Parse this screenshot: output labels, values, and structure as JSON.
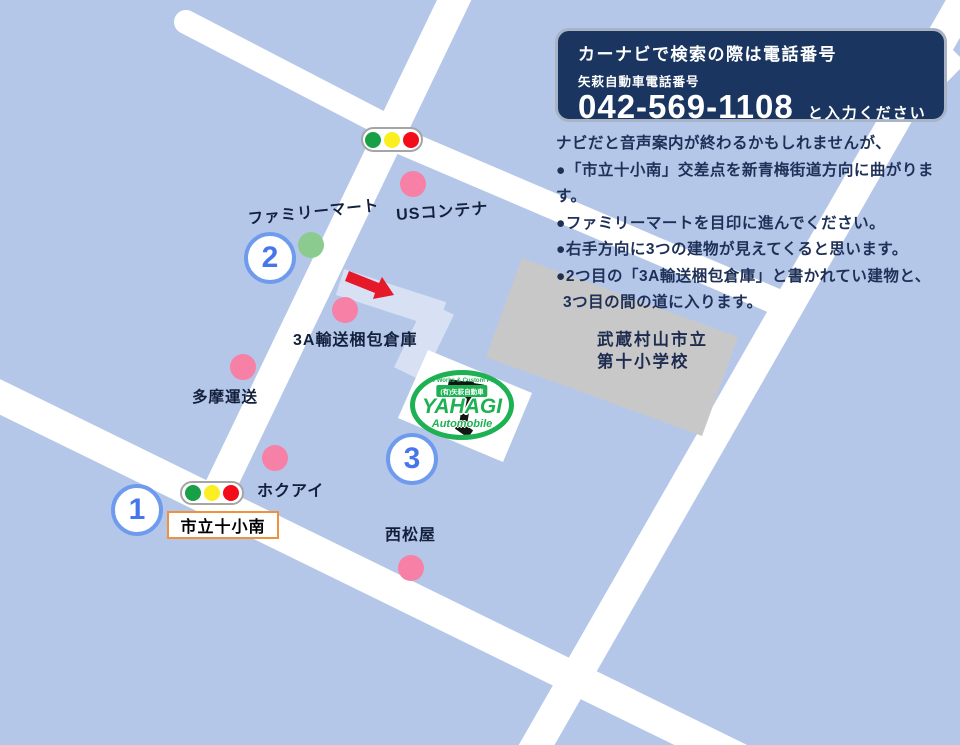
{
  "info_box": {
    "title": "カーナビで検索の際は電話番号",
    "subtitle": "矢萩自動車電話番号",
    "phone": "042-569-1108",
    "phone_suffix": "と入力ください"
  },
  "directions": {
    "intro": "ナビだと音声案内が終わるかもしれませんが、",
    "steps": [
      "●「市立十小南」交差点を新青梅街道方向に曲がります。",
      "●ファミリーマートを目印に進んでください。",
      "●右手方向に3つの建物が見えてくると思います。",
      "●2つ目の「3A輸送梱包倉庫」と書かれてい建物と、",
      "3つ目の間の道に入ります。"
    ]
  },
  "landmarks": {
    "family_mart": "ファミリーマート",
    "us_container": "USコンテナ",
    "warehouse_3a": "3A輸送梱包倉庫",
    "tama_unsou": "多摩運送",
    "hokuai": "ホクアイ",
    "nishimatsuya": "西松屋",
    "school_line1": "武蔵村山市立",
    "school_line2": "第十小学校"
  },
  "intersection_label": "市立十小南",
  "route_markers": [
    "1",
    "2",
    "3"
  ],
  "logo": {
    "arc_text": "New Works & Custom Paint",
    "badge": "(有)矢萩自動車",
    "name": "YAHAGI",
    "subname": "Automobile"
  },
  "colors": {
    "map_background": "#b5c7e9",
    "road": "#ffffff",
    "route_path": "#d7e1f3",
    "school_building": "#c8c8c8",
    "info_box_background": "#1a3660",
    "instruction_text": "#1e3057",
    "pink_marker": "#f780a6",
    "green_marker": "#8bcb90",
    "route_circle_blue": "#6f9bef",
    "intersection_border_orange": "#ed9340",
    "arrow_red": "#e6192b",
    "logo_green": "#1eb153",
    "signal_green": "#18a047",
    "signal_yellow": "#fbee21",
    "signal_red": "#f20d18"
  }
}
